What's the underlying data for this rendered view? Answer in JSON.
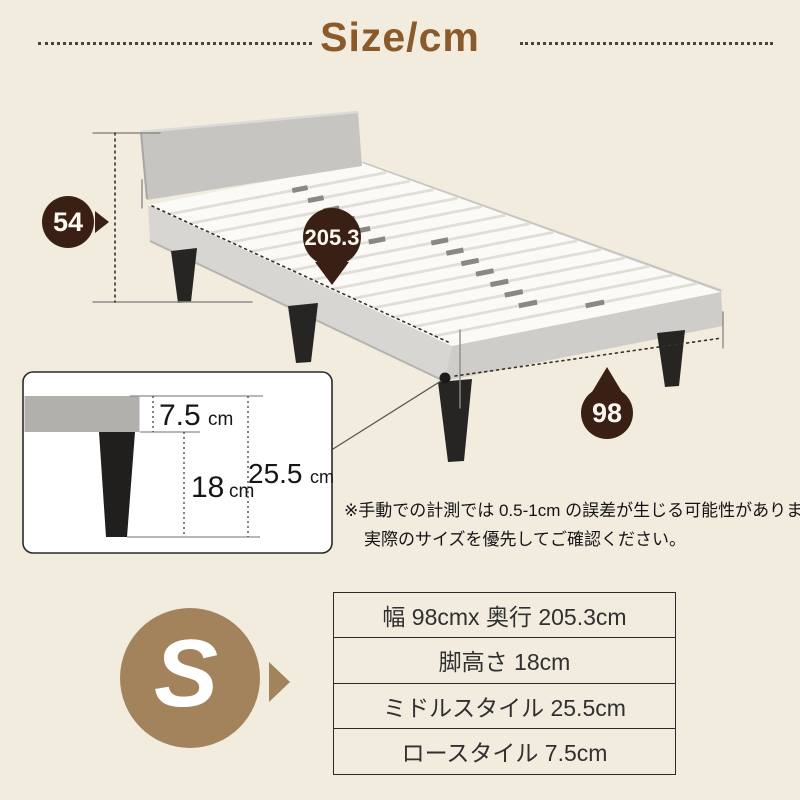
{
  "title": "Size/cm",
  "dimensions": {
    "headboard_height": "54",
    "length": "205.3",
    "width": "98"
  },
  "leg_detail": {
    "low_style": {
      "value": "7.5",
      "unit": "cm"
    },
    "leg_height": {
      "value": "18",
      "unit": "cm"
    },
    "middle_style": {
      "value": "25.5",
      "unit": "cm"
    }
  },
  "note": {
    "line1": "※手動での計測では 0.5-1cm の誤差が生じる可能性があります。",
    "line2": "実際のサイズを優先してご確認ください。"
  },
  "size_badge": "S",
  "spec_table": {
    "rows": [
      "幅 98cmx 奥行 205.3cm",
      "脚高さ 18cm",
      "ミドルスタイル 25.5cm",
      "ロースタイル 7.5cm"
    ]
  },
  "colors": {
    "background": "#f2ecdf",
    "title_brown": "#8b5a2b",
    "badge_dark_brown": "#3a2014",
    "badge_tan": "#a3835c"
  }
}
